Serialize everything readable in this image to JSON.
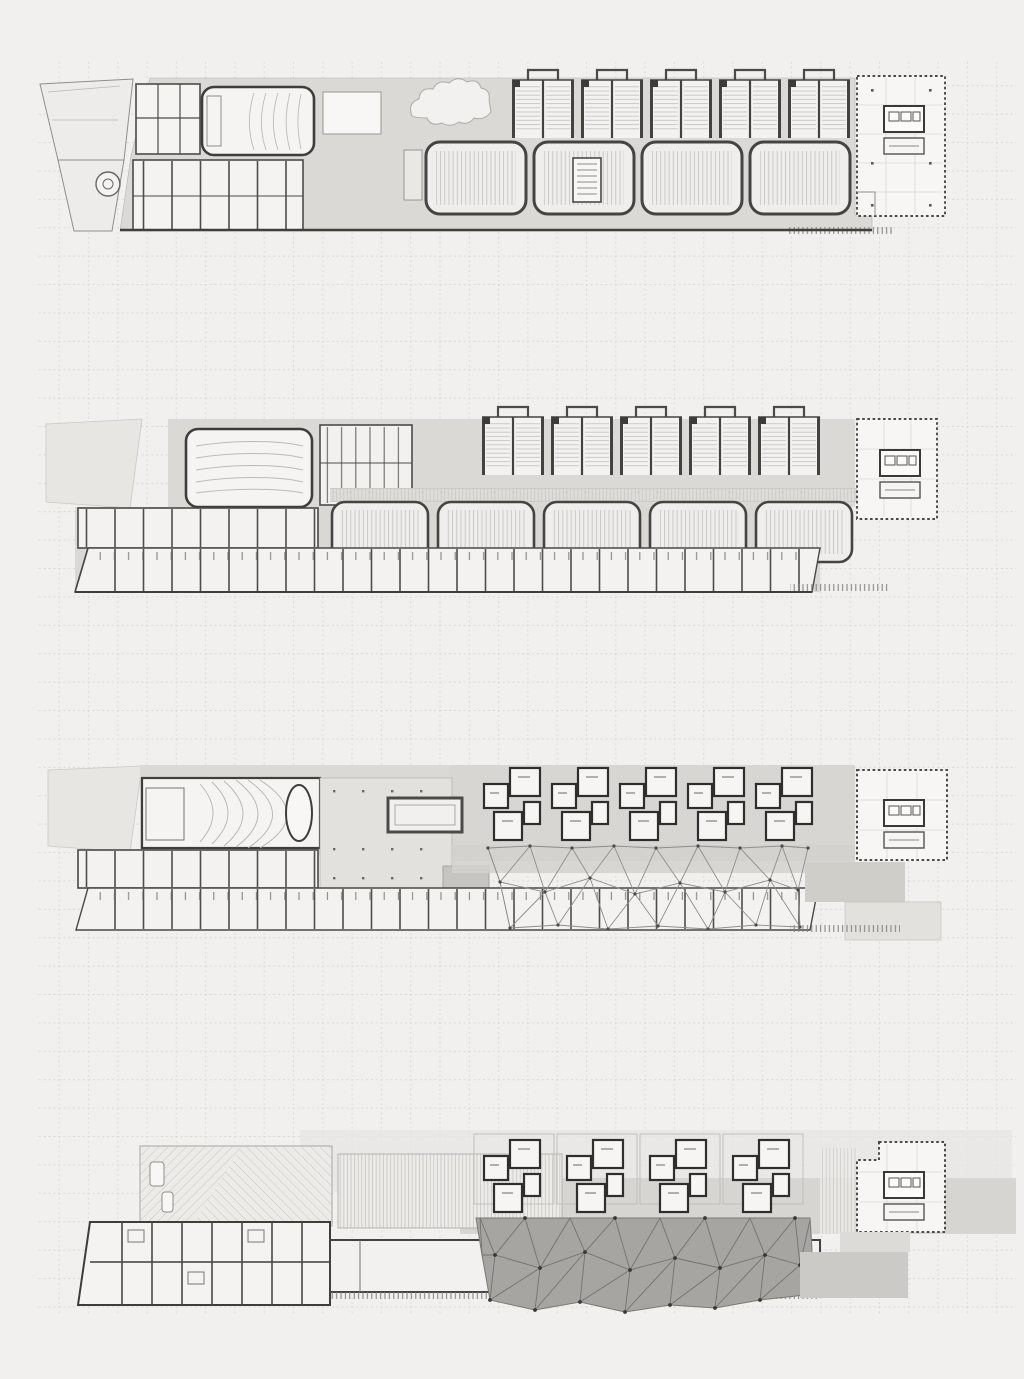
{
  "figure": {
    "kind": "architectural-floor-plan-sheet",
    "levels_count": 4
  },
  "canvas": {
    "width": 1024,
    "height": 1379
  },
  "colors": {
    "background": "#f1f0ee",
    "grid_line": "#dcdad8",
    "band_fill": "#dbd9d6",
    "band_dark": "#cfcdca",
    "room_fill": "#f5f4f2",
    "wall_bold": "#3e3d3b",
    "wall_medium": "#75746f",
    "line_light": "#b3b2af",
    "ghost_fill": "#e8e6e3",
    "canopy_fill": "#a7a5a1",
    "canopy_line": "#73726f",
    "canopy_node": "#3a3938",
    "seat_line": "#c0bfbc",
    "deck_line": "#c6c5c2",
    "tick_line": "#7e7d7b"
  }
}
